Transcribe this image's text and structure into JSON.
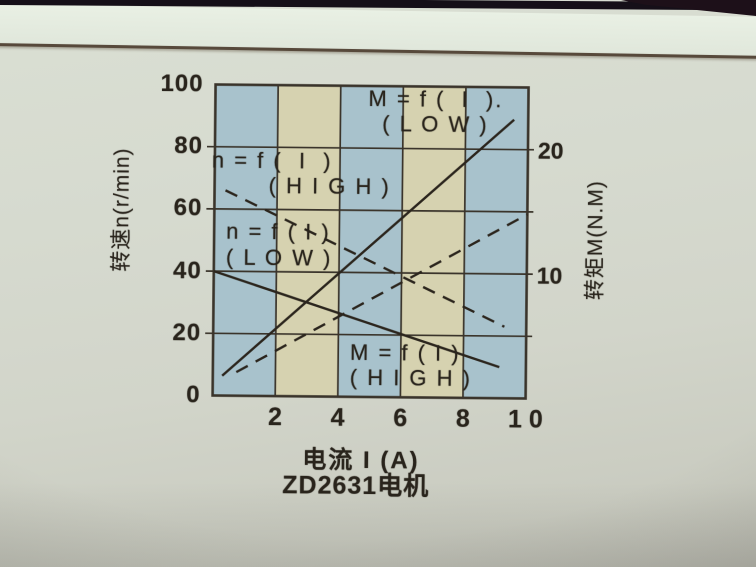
{
  "chart": {
    "left_axis": {
      "label": "转速n(r/min)"
    },
    "right_axis": {
      "label": "转矩M(N.M)"
    },
    "x_axis": {
      "label": "电流 I (A)"
    },
    "caption": "ZD2631电机",
    "curve_labels": {
      "m_low": {
        "line1": "M = f (  I  ).",
        "line2": "( L O W )"
      },
      "n_high": {
        "line1": "n = f (  I  )",
        "line2": "( H I G H )"
      },
      "n_low": {
        "line1": "n = f ( I )",
        "line2": "( L O W )"
      },
      "m_high": {
        "line1": "M = f ( I )",
        "line2": "( H I G H )"
      }
    }
  },
  "chart_data": {
    "type": "line",
    "title": "ZD2631电机",
    "xlabel": "电流 I (A)",
    "ylabel_left": "转速n(r/min)",
    "ylabel_right": "转矩M(N.M)",
    "xlim": [
      0,
      10
    ],
    "ylim_left": [
      0,
      100
    ],
    "ylim_right": [
      0,
      25
    ],
    "grid": true,
    "legend_position": "inline-labels",
    "grid_color": "#3a342b",
    "curve_color": "#2b251d",
    "x_ticks": [
      {
        "v": 2,
        "label": "2"
      },
      {
        "v": 4,
        "label": "4"
      },
      {
        "v": 6,
        "label": "6"
      },
      {
        "v": 8,
        "label": "8"
      },
      {
        "v": 10,
        "label": "1 0"
      }
    ],
    "y_left_ticks": [
      {
        "v": 100,
        "label": "100"
      },
      {
        "v": 80,
        "label": "80"
      },
      {
        "v": 60,
        "label": "60"
      },
      {
        "v": 40,
        "label": "40"
      },
      {
        "v": 20,
        "label": "20"
      },
      {
        "v": 0,
        "label": "0"
      }
    ],
    "y_right_ticks": [
      {
        "v": 20,
        "label": "20"
      },
      {
        "v": 10,
        "label": "10"
      }
    ],
    "grid_x": [
      2,
      4,
      6,
      8
    ],
    "grid_y_left": [
      20,
      40,
      60,
      80
    ],
    "bands": [
      {
        "x0": 0,
        "x1": 2,
        "color": "#a8c2cc"
      },
      {
        "x0": 2,
        "x1": 4,
        "color": "#d6d2b0"
      },
      {
        "x0": 4,
        "x1": 6,
        "color": "#a8c2cc"
      },
      {
        "x0": 6,
        "x1": 8,
        "color": "#d6d2b0"
      },
      {
        "x0": 8,
        "x1": 10,
        "color": "#a8c2cc"
      }
    ],
    "series": [
      {
        "id": "n-high",
        "name": "n = f(I) (HIGH)",
        "axis": "left",
        "style": "dashed",
        "points": [
          [
            0.35,
            66
          ],
          [
            9.3,
            23
          ]
        ]
      },
      {
        "id": "n-low",
        "name": "n = f(I) (LOW)",
        "axis": "left",
        "style": "solid",
        "points": [
          [
            0,
            40
          ],
          [
            9.15,
            10
          ]
        ]
      },
      {
        "id": "m-low",
        "name": "M = f(I) (LOW)",
        "axis": "right",
        "style": "solid",
        "points": [
          [
            0.3,
            1.6
          ],
          [
            9.55,
            22.4
          ]
        ]
      },
      {
        "id": "m-high",
        "name": "M = f(I) (HIGH)",
        "axis": "right",
        "style": "dashed",
        "points": [
          [
            0.75,
            1.9
          ],
          [
            10,
            14.8
          ]
        ]
      }
    ]
  }
}
